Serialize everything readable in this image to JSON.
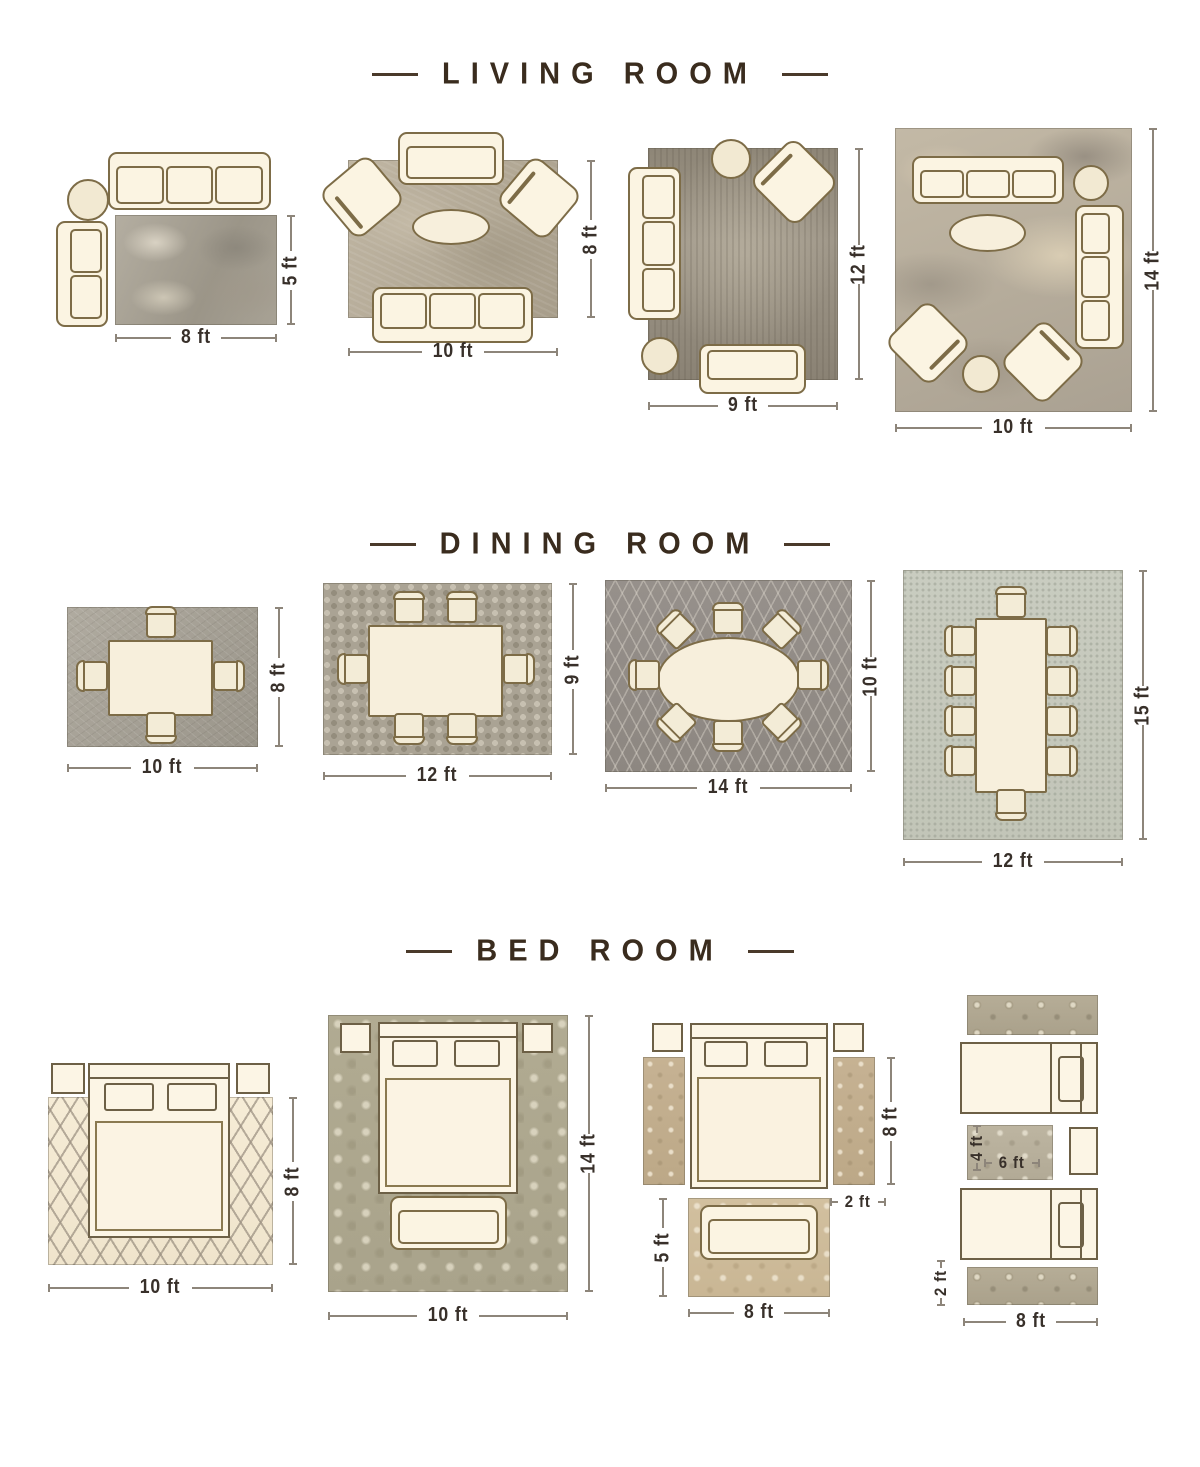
{
  "page_title": "Rug size placement guide",
  "colors": {
    "background": "#ffffff",
    "title_text": "#3a2c1e",
    "dimension_text": "#38302a",
    "dimension_line": "#8d857a",
    "furniture_fill": "#fbf4e2",
    "furniture_outline": "#7d6c47"
  },
  "sections": [
    {
      "id": "living-room",
      "title": "LIVING ROOM",
      "layouts": [
        {
          "width_label": "8 ft",
          "height_label": "5 ft",
          "furniture": [
            "three-seat-sofa",
            "round-side-table",
            "two-seat-sofa",
            "area-rug"
          ]
        },
        {
          "width_label": "10 ft",
          "height_label": "8 ft",
          "furniture": [
            "loveseat",
            "armchair",
            "armchair",
            "oval-coffee-table",
            "three-seat-sofa",
            "area-rug"
          ]
        },
        {
          "width_label": "9 ft",
          "height_label": "12 ft",
          "furniture": [
            "round-table",
            "armchair",
            "three-seat-sofa",
            "round-ottoman",
            "loveseat",
            "area-rug"
          ]
        },
        {
          "width_label": "10 ft",
          "height_label": "14 ft",
          "furniture": [
            "three-seat-sofa",
            "round-side-table",
            "three-seat-sofa",
            "oval-coffee-table",
            "armchair",
            "armchair",
            "round-ottoman",
            "area-rug"
          ]
        }
      ]
    },
    {
      "id": "dining-room",
      "title": "DINING ROOM",
      "layouts": [
        {
          "width_label": "10 ft",
          "height_label": "8 ft",
          "furniture": [
            "square-dining-table",
            "4-chairs",
            "area-rug"
          ]
        },
        {
          "width_label": "12 ft",
          "height_label": "9 ft",
          "furniture": [
            "rectangular-dining-table",
            "6-chairs",
            "area-rug"
          ]
        },
        {
          "width_label": "14 ft",
          "height_label": "10 ft",
          "furniture": [
            "oval-dining-table",
            "8-chairs",
            "area-rug"
          ]
        },
        {
          "width_label": "12 ft",
          "height_label": "15 ft",
          "furniture": [
            "long-dining-table",
            "10-chairs",
            "area-rug"
          ]
        }
      ]
    },
    {
      "id": "bed-room",
      "title": "BED ROOM",
      "layouts": [
        {
          "width_label": "10 ft",
          "height_label": "8 ft",
          "furniture": [
            "queen-bed",
            "nightstand",
            "nightstand",
            "area-rug"
          ]
        },
        {
          "width_label": "10 ft",
          "height_label": "14 ft",
          "furniture": [
            "queen-bed",
            "nightstand",
            "nightstand",
            "bench",
            "area-rug"
          ]
        },
        {
          "runner_length_label": "8 ft",
          "runner_width_label": "2 ft",
          "foot_rug_height_label": "5 ft",
          "foot_rug_width_label": "8 ft",
          "furniture": [
            "queen-bed",
            "nightstand",
            "nightstand",
            "runner-rug",
            "runner-rug",
            "loveseat",
            "foot-rug"
          ]
        },
        {
          "between_rug_height_label": "4 ft",
          "between_rug_width_label": "6 ft",
          "runner_width_label": "2 ft",
          "runner_length_label": "8 ft",
          "furniture": [
            "twin-bed",
            "twin-bed",
            "nightstand",
            "runner-rug",
            "runner-rug",
            "between-beds-rug"
          ]
        }
      ]
    }
  ]
}
